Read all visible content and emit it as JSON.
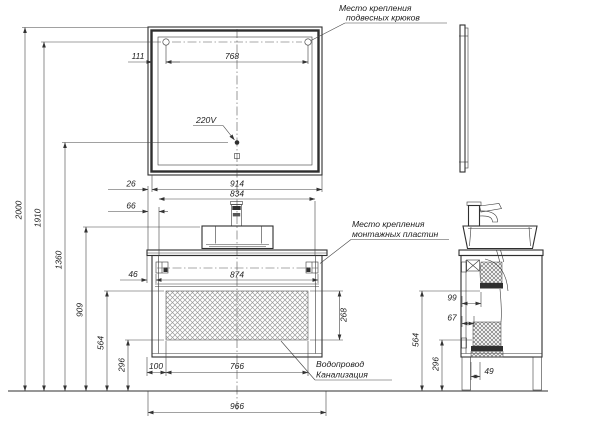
{
  "drawing": {
    "notes": {
      "hooks_1": "Место крепления",
      "hooks_2": "подвесных крюков",
      "plates_1": "Место крепления",
      "plates_2": "монтажных пластин",
      "outlet": "220V",
      "plumbing_1": "Водопровод",
      "plumbing_2": "Канализация"
    },
    "front": {
      "width_total": "966",
      "width_mirror": "914",
      "width_inner": "834",
      "width_plates": "874",
      "width_hooks": "768",
      "width_hatch": "766",
      "hatch_offset": "100",
      "hook_offset": "111",
      "offset_mirror": "26",
      "offset_inner": "66",
      "offset_plate": "46",
      "hatch_height": "268",
      "height_total": "2000",
      "height_hooks": "1910",
      "height_outlet": "1360",
      "height_basin": "909",
      "height_drain": "564",
      "height_inlet": "296"
    },
    "side": {
      "drain_x": "99",
      "inlet_x": "67",
      "height_drain": "564",
      "height_inlet": "296",
      "foot_x": "49"
    }
  }
}
